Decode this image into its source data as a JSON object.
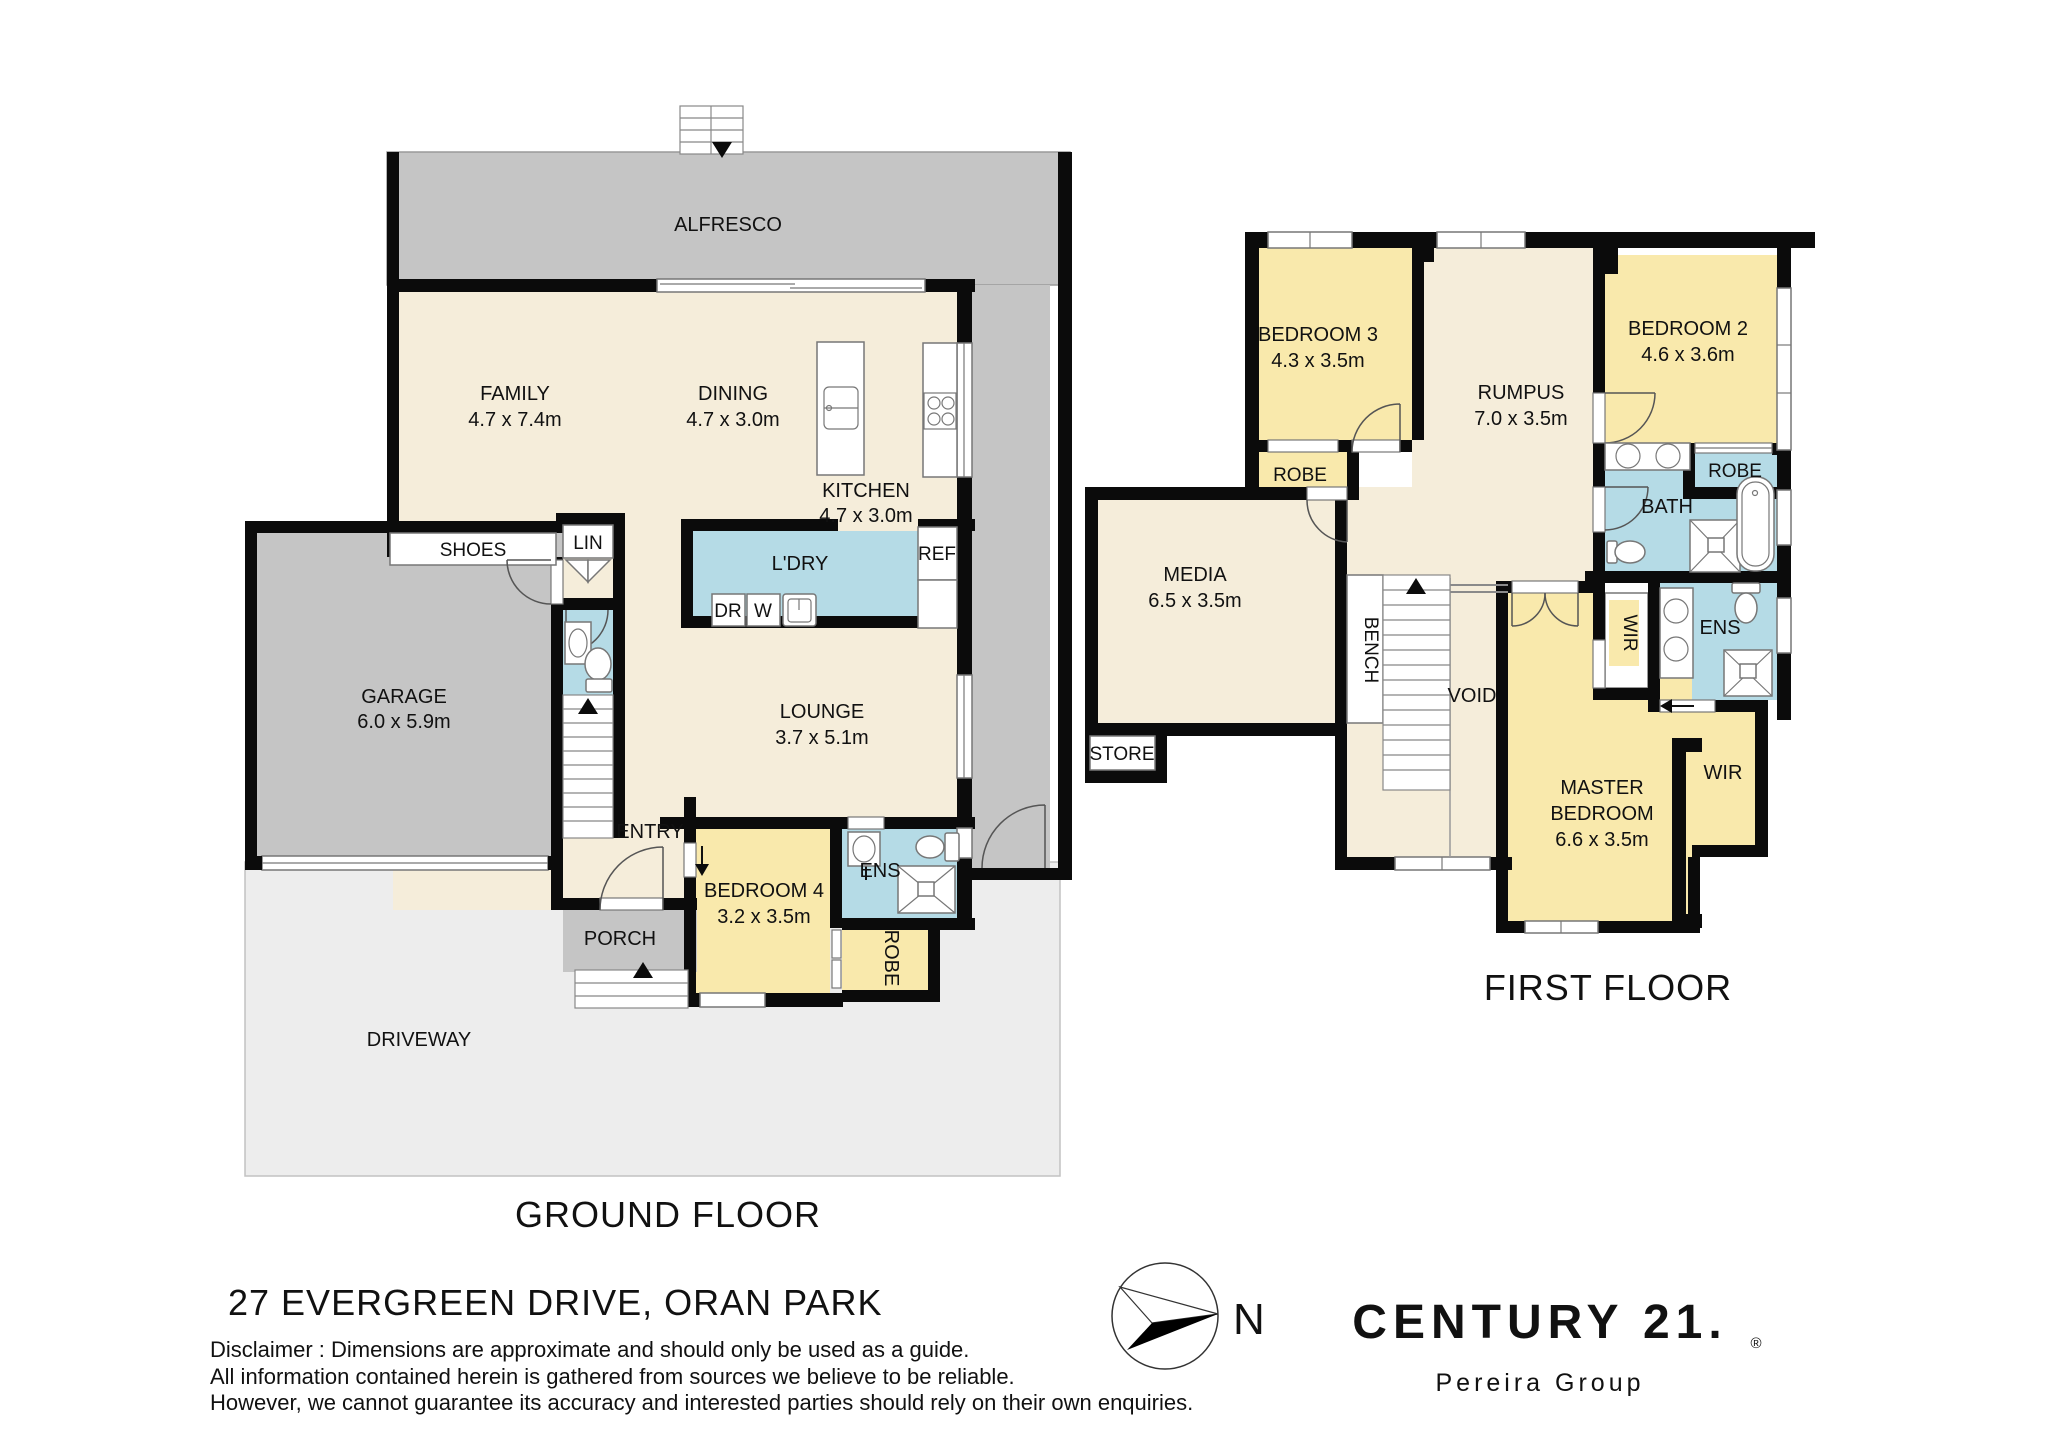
{
  "titles": {
    "ground": "GROUND FLOOR",
    "first": "FIRST FLOOR"
  },
  "address": "27 EVERGREEN DRIVE, ORAN PARK",
  "disclaimer": {
    "line1": "Disclaimer : Dimensions are approximate and should only be used as a guide.",
    "line2": "All information contained herein is gathered from sources we believe to be reliable.",
    "line3": "However, we cannot guarantee its accuracy and interested parties should rely on their own enquiries."
  },
  "compass": {
    "north": "N"
  },
  "logo": {
    "brand": "CENTURY 21.",
    "reg": "®",
    "sub": "Pereira Group",
    "color": "#b3a284"
  },
  "gf": {
    "alfresco": {
      "label": "ALFRESCO"
    },
    "family": {
      "label": "FAMILY",
      "dims": "4.7 x 7.4m"
    },
    "dining": {
      "label": "DINING",
      "dims": "4.7 x 3.0m"
    },
    "kitchen": {
      "label": "KITCHEN",
      "dims": "4.7 x 3.0m"
    },
    "shoes": {
      "label": "SHOES"
    },
    "lin": {
      "label": "LIN"
    },
    "ldry": {
      "label": "L'DRY"
    },
    "ref": {
      "label": "REF"
    },
    "dr": {
      "label": "DR"
    },
    "w": {
      "label": "W"
    },
    "garage": {
      "label": "GARAGE",
      "dims": "6.0 x 5.9m"
    },
    "lounge": {
      "label": "LOUNGE",
      "dims": "3.7 x 5.1m"
    },
    "entry": {
      "label": "ENTRY"
    },
    "bed4": {
      "label": "BEDROOM 4",
      "dims": "3.2 x 3.5m"
    },
    "ens": {
      "label": "ENS"
    },
    "robe": {
      "label": "ROBE"
    },
    "porch": {
      "label": "PORCH"
    },
    "driveway": {
      "label": "DRIVEWAY"
    }
  },
  "ff": {
    "bed3": {
      "label": "BEDROOM 3",
      "dims": "4.3 x 3.5m"
    },
    "rumpus": {
      "label": "RUMPUS",
      "dims": "7.0 x 3.5m"
    },
    "bed2": {
      "label": "BEDROOM 2",
      "dims": "4.6 x 3.6m"
    },
    "robe3": {
      "label": "ROBE"
    },
    "robe2": {
      "label": "ROBE"
    },
    "bath": {
      "label": "BATH"
    },
    "media": {
      "label": "MEDIA",
      "dims": "6.5 x 3.5m"
    },
    "bench": {
      "label": "BENCH"
    },
    "store": {
      "label": "STORE"
    },
    "void": {
      "label": "VOID"
    },
    "wir1": {
      "label": "WIR"
    },
    "ens": {
      "label": "ENS"
    },
    "master": {
      "label1": "MASTER",
      "label2": "BEDROOM",
      "dims": "6.6 x 3.5m"
    },
    "wir2": {
      "label": "WIR"
    }
  }
}
